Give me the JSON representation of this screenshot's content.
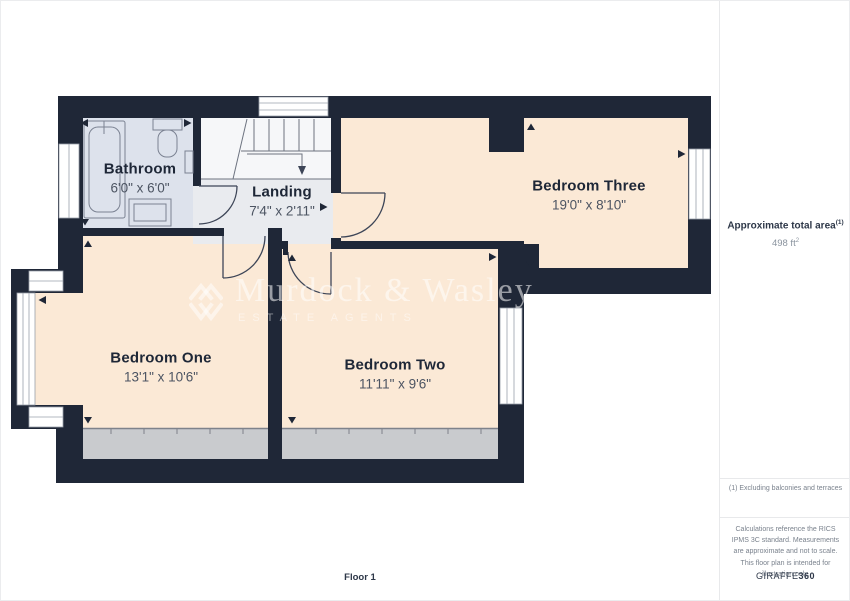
{
  "plan": {
    "floor_label": "Floor 1",
    "rooms": [
      {
        "name": "Bathroom",
        "dims": "6'0\" x 6'0\""
      },
      {
        "name": "Landing",
        "dims": "7'4\" x 2'11\""
      },
      {
        "name": "Bedroom Three",
        "dims": "19'0\" x 8'10\""
      },
      {
        "name": "Bedroom One",
        "dims": "13'1\" x 10'6\""
      },
      {
        "name": "Bedroom Two",
        "dims": "11'11\" x 9'6\""
      }
    ]
  },
  "watermark": {
    "name": "Murdock & Wasley",
    "subtitle": "ESTATE AGENTS"
  },
  "sidebar": {
    "area_label": "Approximate total area",
    "area_footnote_marker": "(1)",
    "area_value": "498 ft",
    "area_value_sup": "2",
    "footnote": "(1) Excluding balconies and terraces",
    "disclaimer": "Calculations reference the RICS IPMS 3C standard. Measurements are approximate and not to scale. This floor plan is intended for illustration only.",
    "brand_name": "GIRAFFE",
    "brand_suffix": "360"
  },
  "colors": {
    "wall": "#1f2737",
    "bedroom_floor": "#fbe9d6",
    "bathroom_floor": "#dde2ec",
    "landing_floor": "#e9ebef",
    "stairwell": "#f6f7f9",
    "eaves_gray": "#c9cbce"
  }
}
